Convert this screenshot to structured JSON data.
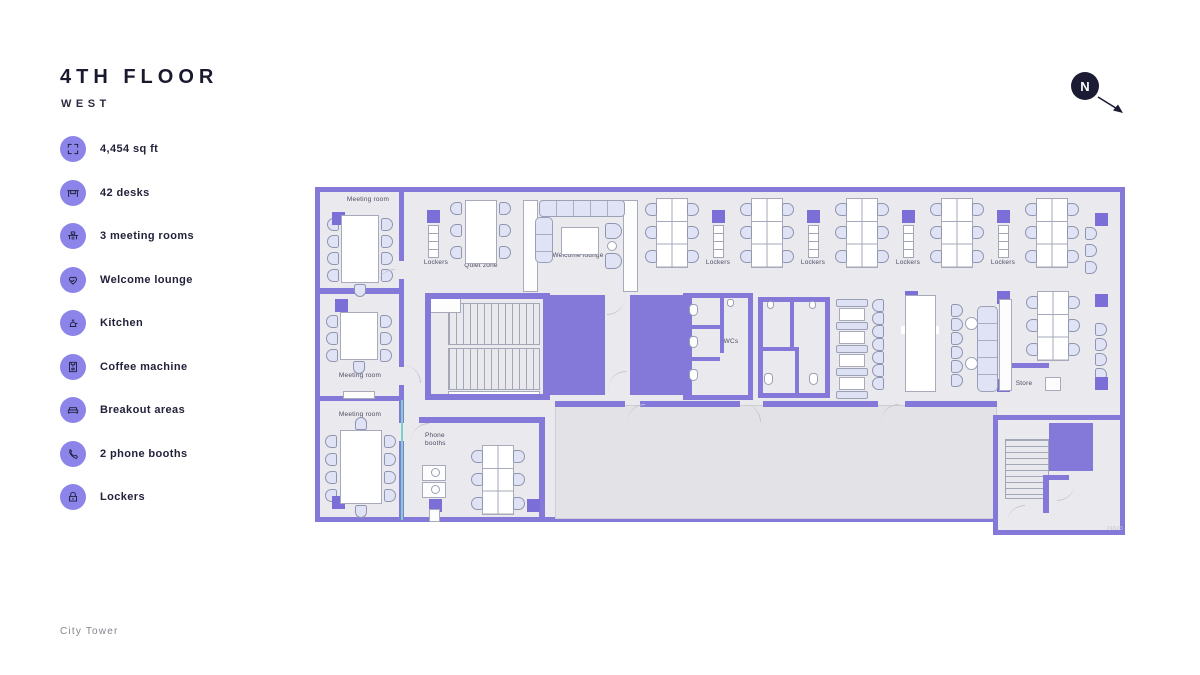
{
  "header": {
    "title": "4TH FLOOR",
    "subtitle": "WEST"
  },
  "compass": {
    "label": "N"
  },
  "legend": [
    {
      "icon": "area-icon",
      "label": "4,454 sq ft"
    },
    {
      "icon": "desk-icon",
      "label": "42 desks"
    },
    {
      "icon": "meeting-room-icon",
      "label": "3 meeting rooms"
    },
    {
      "icon": "welcome-lounge-icon",
      "label": "Welcome lounge"
    },
    {
      "icon": "kitchen-icon",
      "label": "Kitchen"
    },
    {
      "icon": "coffee-machine-icon",
      "label": "Coffee machine"
    },
    {
      "icon": "breakout-icon",
      "label": "Breakout areas"
    },
    {
      "icon": "phone-booth-icon",
      "label": "2 phone booths"
    },
    {
      "icon": "lockers-icon",
      "label": "Lockers"
    }
  ],
  "plan": {
    "labels": {
      "meeting_room": "Meeting room",
      "lockers": "Lockers",
      "quiet_zone": "Quiet zone",
      "welcome_lounge": "Welcome lounge",
      "lift": "Lift",
      "wcs": "WCs",
      "kitchen": "Kitchen",
      "store": "Store",
      "phone_line1": "Phone",
      "phone_line2": "booths",
      "ref": "24N03"
    }
  },
  "footer": {
    "location": "City Tower"
  },
  "colors": {
    "wall": "#8478d9",
    "accent": "#8c84e9",
    "ink": "#1a1a2e"
  }
}
